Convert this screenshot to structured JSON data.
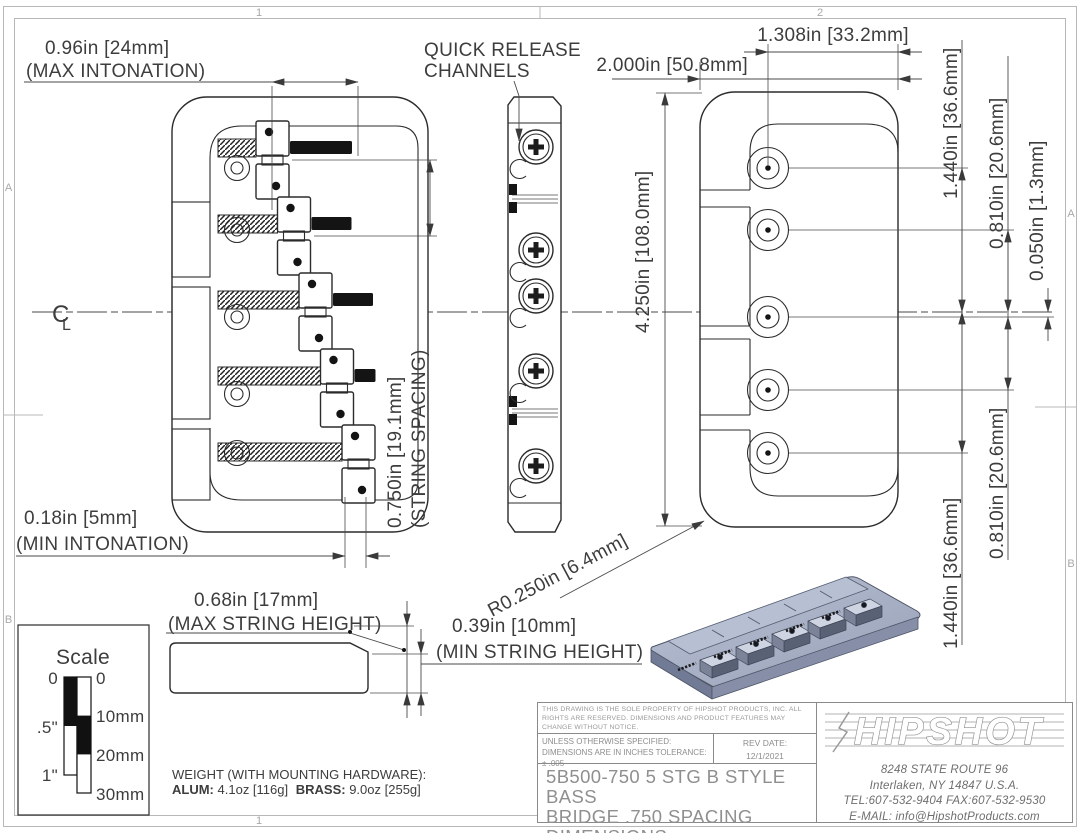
{
  "zones": {
    "top_left": "1",
    "top_right": "2",
    "bottom_left": "1",
    "left_top": "A",
    "left_bottom": "B",
    "right_top": "A",
    "right_bottom": "B"
  },
  "centerline_symbol": {
    "c": "C",
    "l": "L"
  },
  "dims": {
    "max_intonation_val": "0.96in [24mm]",
    "max_intonation_cap": "(MAX INTONATION)",
    "quick_release_1": "QUICK RELEASE",
    "quick_release_2": "CHANNELS",
    "overall_width": "2.000in [50.8mm]",
    "edge_to_hole": "1.308in [33.2mm]",
    "overall_length": "4.250in [108.0mm]",
    "hole_span_outer_top": "1.440in [36.6mm]",
    "hole_span_inner_top": "0.810in [20.6mm]",
    "center_offset": "0.050in [1.3mm]",
    "hole_span_inner_bottom": "0.810in [20.6mm]",
    "hole_span_outer_bottom": "1.440in [36.6mm]",
    "string_spacing_val": "0.750in [19.1mm]",
    "string_spacing_cap": "(STRING SPACING)",
    "min_intonation_val": "0.18in [5mm]",
    "min_intonation_cap": "(MIN INTONATION)",
    "corner_radius": "R0.250in [6.4mm]",
    "max_string_height_val": "0.68in [17mm]",
    "max_string_height_cap": "(MAX STRING HEIGHT)",
    "min_string_height_val": "0.39in [10mm]",
    "min_string_height_cap": "(MIN STRING HEIGHT)"
  },
  "scale_box": {
    "title": "Scale",
    "in0": "0",
    "in_half": ".5\"",
    "in1": "1\"",
    "mm0": "0",
    "mm10": "10mm",
    "mm20": "20mm",
    "mm30": "30mm"
  },
  "weight": {
    "heading": "WEIGHT (WITH MOUNTING HARDWARE):",
    "alum_label": "ALUM:",
    "alum_value": "4.1oz [116g]",
    "brass_label": "BRASS:",
    "brass_value": "9.0oz [255g]"
  },
  "title_block": {
    "legal": "THIS DRAWING IS THE SOLE PROPERTY OF HIPSHOT PRODUCTS, INC. ALL RIGHTS ARE RESERVED. DIMENSIONS AND PRODUCT FEATURES MAY CHANGE WITHOUT NOTICE.",
    "spec": "UNLESS OTHERWISE SPECIFIED: DIMENSIONS ARE IN INCHES TOLERANCE: ± .005",
    "rev_label": "REV DATE:",
    "rev_date": "12/1/2021",
    "title_line1": "5B500-750 5 STG B STYLE BASS",
    "title_line2": "BRIDGE .750 SPACING",
    "title_line3": "DIMENSIONS",
    "logo": "HIPSHOT",
    "address1": "8248 STATE ROUTE 96",
    "address2": "Interlaken, NY 14847 U.S.A.",
    "phone": "TEL:607-532-9404 FAX:607-532-9530",
    "email": "E-MAIL: info@HipshotProducts.com"
  }
}
